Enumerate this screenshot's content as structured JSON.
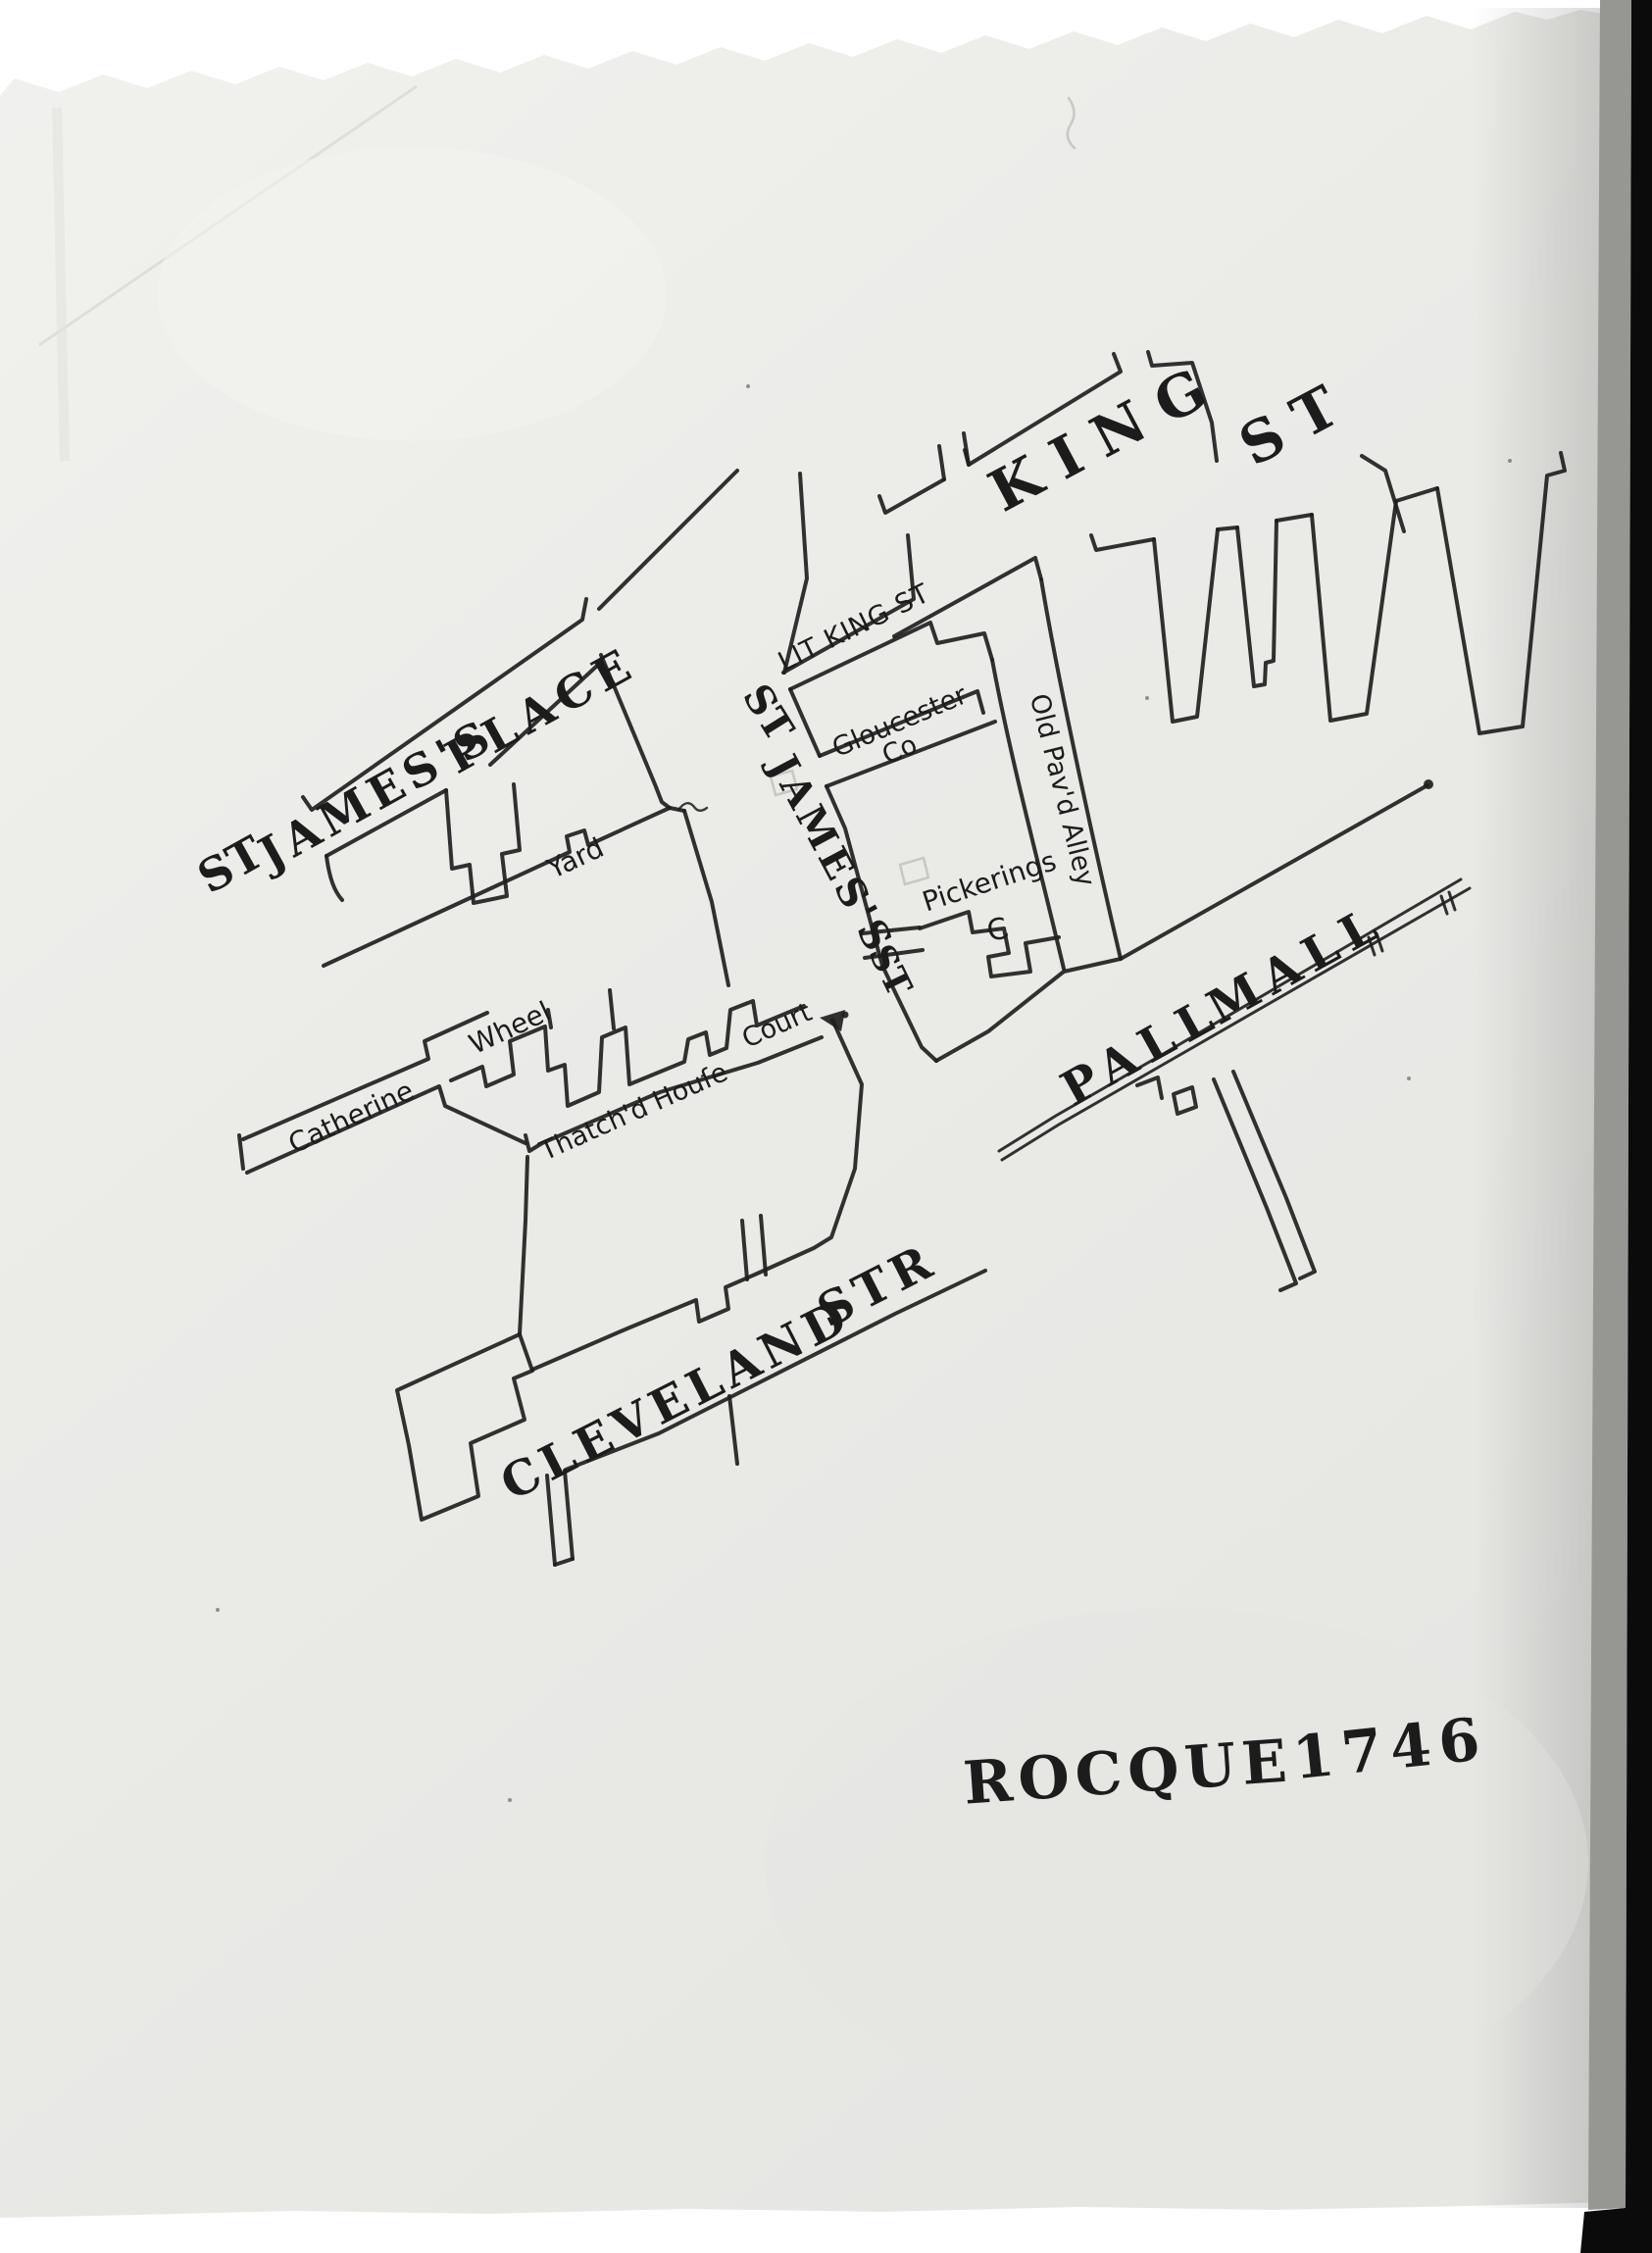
{
  "document": {
    "kind": "photograph of a hand-drawn street map on torn paper",
    "caption_word": "ROCQUE",
    "caption_year": "1746"
  },
  "map_labels": {
    "king_word": "KING",
    "king_st": "ST",
    "lit_king_st": "LIT KING ST",
    "gloucester": "Gloucester",
    "gloucester_co": "Co",
    "old_pavd_alley": "Old Pav'd Alley",
    "pickerings": "Pickerings",
    "pickerings_c": "C",
    "place_st": "ST",
    "place_james": "JAMES'S",
    "place_place": "PLACE",
    "stjames_st1": "ST",
    "stjames_james": "JAMES'S",
    "stjames_st2": "ST",
    "pall": "PALL",
    "mall": "MALL",
    "catherine": "Catherine",
    "wheel": "Wheel",
    "yard": "Yard",
    "thatchd_house": "Thatch'd Houſe",
    "court": "Court",
    "cleveland": "CLEVELAND",
    "str": "STR",
    "rocque": "ROCQUE",
    "year": "1746"
  },
  "colors": {
    "ink": "#1f1f1f",
    "paper": "#ececE9",
    "photo_edge_black": "#0b0b0b",
    "photo_edge_gray": "#969692"
  }
}
